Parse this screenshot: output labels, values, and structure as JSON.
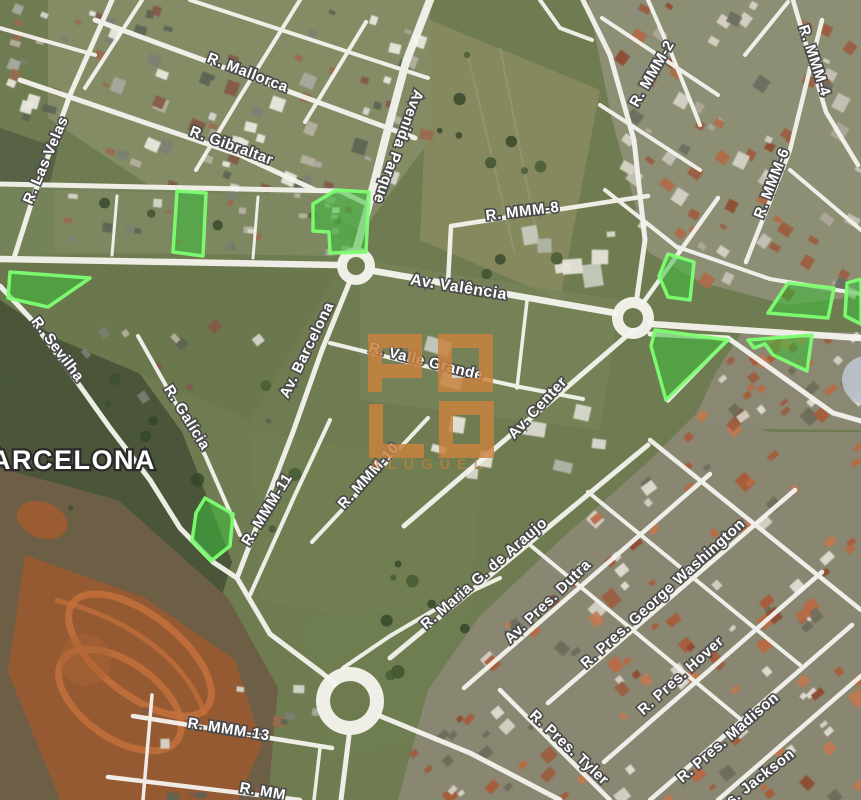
{
  "map": {
    "watermark": {
      "title": "POLO",
      "subtitle": "ALUGUEL",
      "color": "#c9823f"
    },
    "city_label": {
      "text": "BARCELONA",
      "x": 63,
      "y": 469,
      "size": 27
    },
    "street_labels": [
      {
        "text": "R. Mallorca",
        "x": 246,
        "y": 77,
        "rot": 21,
        "size": 15
      },
      {
        "text": "R. Gibraltar",
        "x": 230,
        "y": 150,
        "rot": 20,
        "size": 15
      },
      {
        "text": "R. Las Velas",
        "x": 50,
        "y": 162,
        "rot": -67,
        "size": 15
      },
      {
        "text": "Avenida Parque",
        "x": 394,
        "y": 145,
        "rot": 110,
        "size": 15
      },
      {
        "text": "R. MMM-8",
        "x": 523,
        "y": 216,
        "rot": -7,
        "size": 15
      },
      {
        "text": "Av. Valência",
        "x": 458,
        "y": 292,
        "rot": 9,
        "size": 16
      },
      {
        "text": "R. MMM-2",
        "x": 656,
        "y": 76,
        "rot": -60,
        "size": 15
      },
      {
        "text": "R. MMM-4",
        "x": 810,
        "y": 62,
        "rot": 72,
        "size": 15
      },
      {
        "text": "R. MMM-6",
        "x": 776,
        "y": 185,
        "rot": -69,
        "size": 15
      },
      {
        "text": "R. Sevilha",
        "x": 54,
        "y": 352,
        "rot": 53,
        "size": 15
      },
      {
        "text": "R. Galícia",
        "x": 183,
        "y": 420,
        "rot": 58,
        "size": 15
      },
      {
        "text": "Av. Barcelona",
        "x": 311,
        "y": 352,
        "rot": -64,
        "size": 15
      },
      {
        "text": "R. MMM-11",
        "x": 271,
        "y": 512,
        "rot": -58,
        "size": 15
      },
      {
        "text": "R. MMM-10",
        "x": 372,
        "y": 479,
        "rot": -48,
        "size": 15
      },
      {
        "text": "R. Valle Grande",
        "x": 425,
        "y": 366,
        "rot": 14,
        "size": 15
      },
      {
        "text": "Av. Center",
        "x": 541,
        "y": 411,
        "rot": -47,
        "size": 15
      },
      {
        "text": "R. Maria G. de Araujo",
        "x": 487,
        "y": 577,
        "rot": -41,
        "size": 15
      },
      {
        "text": "Av. Pres. Dutra",
        "x": 551,
        "y": 605,
        "rot": -44,
        "size": 15
      },
      {
        "text": "R. Pres. George Washington",
        "x": 666,
        "y": 597,
        "rot": -42,
        "size": 15
      },
      {
        "text": "R. Pres. Hover",
        "x": 684,
        "y": 679,
        "rot": -42,
        "size": 15
      },
      {
        "text": "R. Pres. Madison",
        "x": 731,
        "y": 741,
        "rot": -41,
        "size": 15
      },
      {
        "text": "R. Pres. Tyler",
        "x": 566,
        "y": 751,
        "rot": 43,
        "size": 15
      },
      {
        "text": "R. Pres. Jackson",
        "x": 745,
        "y": 795,
        "rot": -38,
        "size": 15
      },
      {
        "text": "R. MMM-13",
        "x": 228,
        "y": 734,
        "rot": 9,
        "size": 15
      },
      {
        "text": "R. MM",
        "x": 262,
        "y": 796,
        "rot": 10,
        "size": 15
      }
    ],
    "parcels": [
      {
        "id": "parcel-1",
        "points": "177,191 206,193 203,256 173,252"
      },
      {
        "id": "parcel-2",
        "points": "313,204 336,190 369,192 366,252 330,253 329,232 313,231"
      },
      {
        "id": "parcel-3",
        "points": "10,272 90,278 48,307 8,298"
      },
      {
        "id": "parcel-4",
        "points": "205,498 233,514 230,546 211,561 192,541 196,513"
      },
      {
        "id": "parcel-5",
        "points": "668,254 694,262 690,300 668,297 659,276"
      },
      {
        "id": "parcel-6",
        "points": "788,283 834,288 828,318 768,313"
      },
      {
        "id": "parcel-7",
        "points": "655,330 728,340 666,400 651,346"
      },
      {
        "id": "parcel-8",
        "points": "748,340 812,335 807,371 773,355 765,344 754,348"
      },
      {
        "id": "parcel-9",
        "points": "847,283 861,279 861,324 845,316"
      }
    ],
    "roundabouts": [
      {
        "cx": 356,
        "cy": 266,
        "r": 19,
        "ir": 9
      },
      {
        "cx": 633,
        "cy": 318,
        "r": 21,
        "ir": 10
      },
      {
        "cx": 350,
        "cy": 701,
        "r": 34,
        "ir": 20
      }
    ],
    "poi": {
      "cx": 866,
      "cy": 380,
      "r": 24,
      "color": "#b8c2ca"
    },
    "roads": [
      {
        "name": "mallorca",
        "d": "M95,20 L415,138",
        "w": 5
      },
      {
        "name": "gibraltar",
        "d": "M20,80 L240,155 L315,190",
        "w": 5
      },
      {
        "name": "top-parallel",
        "d": "M190,0 L428,78",
        "w": 4
      },
      {
        "name": "topleft-corner",
        "d": "M0,28 L95,55",
        "w": 4
      },
      {
        "name": "grid-cross-1",
        "d": "M300,0 L238,100 L196,170",
        "w": 4
      },
      {
        "name": "grid-cross-2",
        "d": "M366,22 L305,122",
        "w": 4
      },
      {
        "name": "grid-cross-3",
        "d": "M142,0 L85,88",
        "w": 4
      },
      {
        "name": "las-velas",
        "d": "M112,0 L70,95 L33,198 L14,258",
        "w": 5
      },
      {
        "name": "strip-north",
        "d": "M0,184 L340,191 L365,203",
        "w": 5
      },
      {
        "name": "strip-cross-1",
        "d": "M117,196 L112,255",
        "w": 3
      },
      {
        "name": "strip-cross-2",
        "d": "M258,197 L253,258",
        "w": 3
      },
      {
        "name": "valencia-west",
        "d": "M0,259 L337,265",
        "w": 6.5
      },
      {
        "name": "valencia-mid",
        "d": "M374,271 L615,313",
        "w": 6.5
      },
      {
        "name": "valencia-east",
        "d": "M651,324 L861,338",
        "w": 6.5
      },
      {
        "name": "avenida-parque",
        "d": "M430,0 L406,62 L385,140 L366,215 L357,247",
        "w": 8
      },
      {
        "name": "mmm8",
        "d": "M448,283 L451,226 L607,202 L648,196",
        "w": 4.5
      },
      {
        "name": "mmm8-north-link",
        "d": "M540,0 L560,28 L592,40",
        "w": 4
      },
      {
        "name": "mmm2",
        "d": "M583,0 L610,55 L634,140 L645,240 L637,297",
        "w": 5
      },
      {
        "name": "mmm2-parallel",
        "d": "M648,0 L672,55 L700,125",
        "w": 4
      },
      {
        "name": "mmm4",
        "d": "M793,0 L826,112 L858,165",
        "w": 4.5
      },
      {
        "name": "mmm6",
        "d": "M746,262 L790,150 L822,20",
        "w": 4.5
      },
      {
        "name": "tr-cross-1",
        "d": "M602,18 L718,95",
        "w": 4
      },
      {
        "name": "tr-cross-2",
        "d": "M600,105 L700,170",
        "w": 4
      },
      {
        "name": "tr-cross-3",
        "d": "M605,190 L678,248",
        "w": 4
      },
      {
        "name": "tr-corner",
        "d": "M745,55 L788,2",
        "w": 4
      },
      {
        "name": "tr-edge",
        "d": "M790,170 L861,230",
        "w": 4
      },
      {
        "name": "r2-ne",
        "d": "M643,303 L678,254 L718,198",
        "w": 4.5
      },
      {
        "name": "parcel-north",
        "d": "M678,247 L770,279 L861,294",
        "w": 4
      },
      {
        "name": "r2-se",
        "d": "M650,334 L728,338 L833,413 L861,421",
        "w": 5
      },
      {
        "name": "p7-edge",
        "d": "M728,339 L668,401",
        "w": 3.5
      },
      {
        "name": "barcelona",
        "d": "M350,281 L322,350 L293,432 L263,510 L237,578",
        "w": 5
      },
      {
        "name": "sevilha",
        "d": "M0,286 L30,318 L70,372 L110,428 L150,480 L180,528 L213,562 L237,578",
        "w": 5
      },
      {
        "name": "to-r3",
        "d": "M237,578 L270,634 L322,673 L339,687",
        "w": 5
      },
      {
        "name": "galicia",
        "d": "M138,336 L205,455 L240,535",
        "w": 4
      },
      {
        "name": "mmm11",
        "d": "M250,595 L295,495 L330,420",
        "w": 4
      },
      {
        "name": "mmm10",
        "d": "M312,542 L428,418",
        "w": 4
      },
      {
        "name": "valle-grande",
        "d": "M330,343 L420,365 L520,387 L583,399",
        "w": 4
      },
      {
        "name": "vg-valencia-link",
        "d": "M517,388 L527,301",
        "w": 3.5
      },
      {
        "name": "av-center",
        "d": "M637,327 L545,406 L460,478 L404,526",
        "w": 5
      },
      {
        "name": "r3-ne",
        "d": "M343,668 L390,636 L448,602 L500,578",
        "w": 4
      },
      {
        "name": "mmm13",
        "d": "M133,716 L332,748",
        "w": 4.5
      },
      {
        "name": "bottom-partial",
        "d": "M108,777 L300,800",
        "w": 4.5
      },
      {
        "name": "bl-cross-1",
        "d": "M152,695 L143,800",
        "w": 3.5
      },
      {
        "name": "bl-cross-2",
        "d": "M320,748 L314,800",
        "w": 3.5
      },
      {
        "name": "r3-south",
        "d": "M349,736 L341,800",
        "w": 5
      },
      {
        "name": "r3-se",
        "d": "M380,716 L470,753 L560,800",
        "w": 5
      },
      {
        "name": "tyler",
        "d": "M500,690 L610,800",
        "w": 4.5
      },
      {
        "name": "araujo",
        "d": "M390,658 L648,445",
        "w": 5
      },
      {
        "name": "dutra",
        "d": "M464,688 L710,474",
        "w": 4.5
      },
      {
        "name": "george-washington",
        "d": "M548,703 L795,490",
        "w": 4.5
      },
      {
        "name": "hover",
        "d": "M604,762 L822,572",
        "w": 4.5
      },
      {
        "name": "madison",
        "d": "M650,800 L852,625",
        "w": 4.5
      },
      {
        "name": "jackson",
        "d": "M718,800 L861,676",
        "w": 4.5
      },
      {
        "name": "br-cross-1",
        "d": "M650,440 L861,610",
        "w": 4.5
      },
      {
        "name": "br-cross-2",
        "d": "M588,492 L800,665",
        "w": 4
      },
      {
        "name": "br-cross-3",
        "d": "M530,545 L744,722",
        "w": 4
      }
    ],
    "palette": {
      "road": "#f5f5f0",
      "label_fill": "#ffffff",
      "label_outline": "#4a4a4a",
      "parcel_fill": "#3cbe3c",
      "parcel_stroke": "#7dff72",
      "field": "#6f7c51",
      "roundabout_inner": "#6d7b4e"
    }
  }
}
